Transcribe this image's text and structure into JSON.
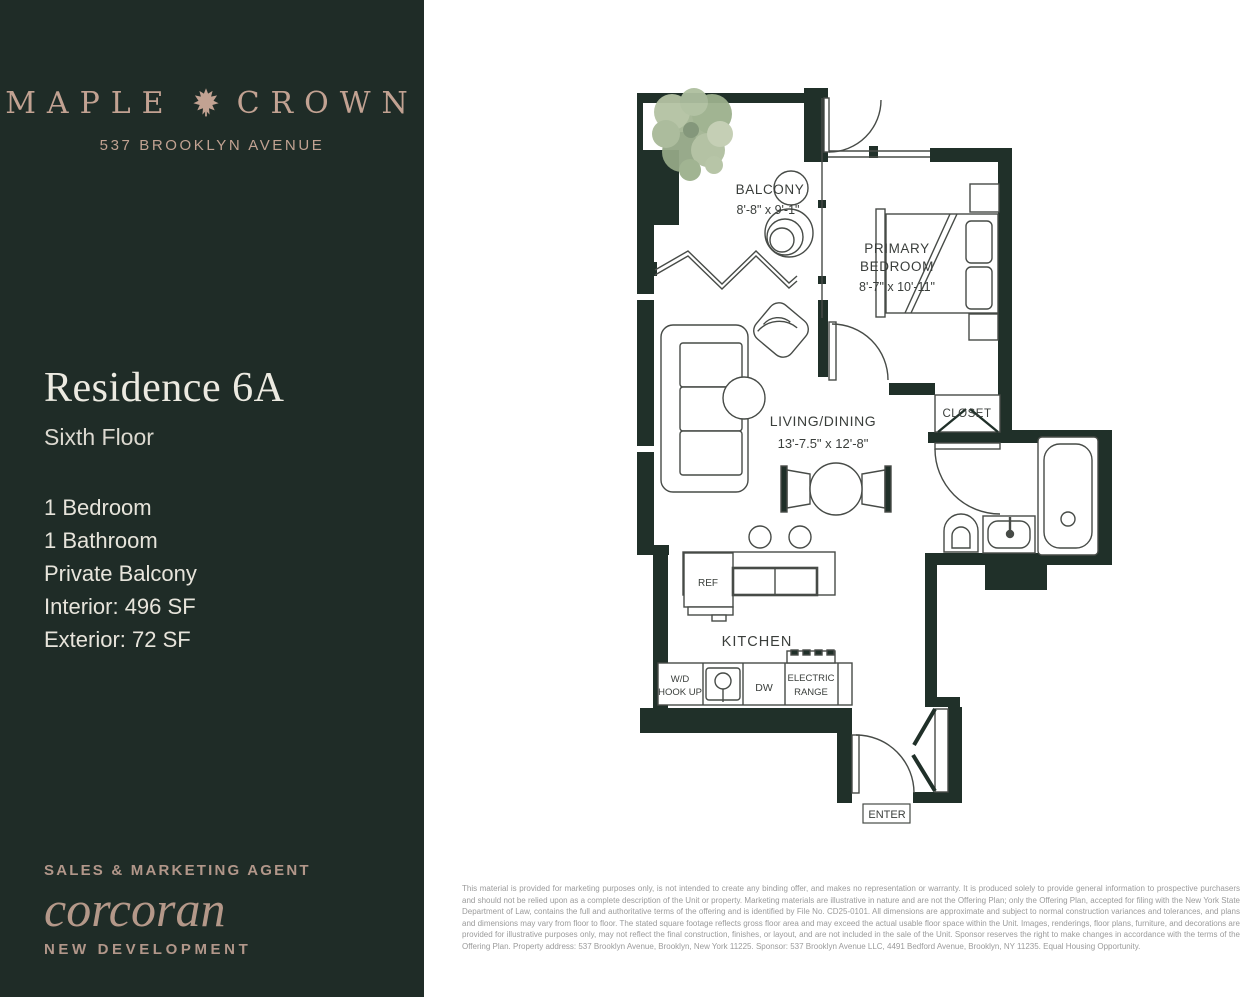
{
  "colors": {
    "sidebar_bg": "#1f2c27",
    "accent_tan": "#c2a292",
    "cream": "#eae7de",
    "wall": "#203029",
    "plan_line": "#474b47",
    "tree_greens": [
      "#aebf9f",
      "#9cb08d",
      "#c2cdb2",
      "#8fa383"
    ]
  },
  "sidebar": {
    "logo": {
      "word1": "MAPLE",
      "word2": "CROWN",
      "icon": "maple-leaf",
      "address": "537 BROOKLYN AVENUE"
    },
    "residence_title": "Residence 6A",
    "residence_floor": "Sixth Floor",
    "features": [
      "1 Bedroom",
      "1 Bathroom",
      "Private Balcony",
      "Interior: 496 SF",
      "Exterior: 72 SF"
    ],
    "agent_label": "SALES & MARKETING AGENT",
    "agent_brand": "corcoran",
    "agent_division": "NEW DEVELOPMENT"
  },
  "floorplan": {
    "balcony_label": "BALCONY",
    "balcony_dims": "8'-8\" x 9'-1\"",
    "bedroom_label_1": "PRIMARY",
    "bedroom_label_2": "BEDROOM",
    "bedroom_dims": "8'-7\" x 10'-11\"",
    "living_label": "LIVING/DINING",
    "living_dims": "13'-7.5\" x 12'-8\"",
    "kitchen_label": "KITCHEN",
    "closet_label": "CLOSET",
    "ref_label": "REF",
    "wd_label_1": "W/D",
    "wd_label_2": "HOOK UP",
    "dw_label": "DW",
    "range_label_1": "ELECTRIC",
    "range_label_2": "RANGE",
    "enter_label": "ENTER"
  },
  "disclaimer": "This material is provided for marketing purposes only, is not intended to create any binding offer, and makes no representation or warranty. It is produced solely to provide general information to prospective purchasers and should not be relied upon as a complete description of the Unit or property. Marketing materials are illustrative in nature and are not the Offering Plan; only the Offering Plan, accepted for filing with the New York State Department of Law, contains the full and authoritative terms of the offering and is identified by File No. CD25-0101. All dimensions are approximate and subject to normal construction variances and tolerances, and plans and dimensions may vary from floor to floor. The stated square footage reflects gross floor area and may exceed the actual usable floor space within the Unit. Images, renderings, floor plans, furniture, and decorations are provided for illustrative purposes only, may not reflect the final construction, finishes, or layout, and are not included in the sale of the Unit. Sponsor reserves the right to make changes in accordance with the terms of the Offering Plan. Property address: 537 Brooklyn Avenue, Brooklyn, New York 11225. Sponsor: 537 Brooklyn Avenue LLC, 4491 Bedford Avenue, Brooklyn, NY 11235. Equal Housing Opportunity."
}
